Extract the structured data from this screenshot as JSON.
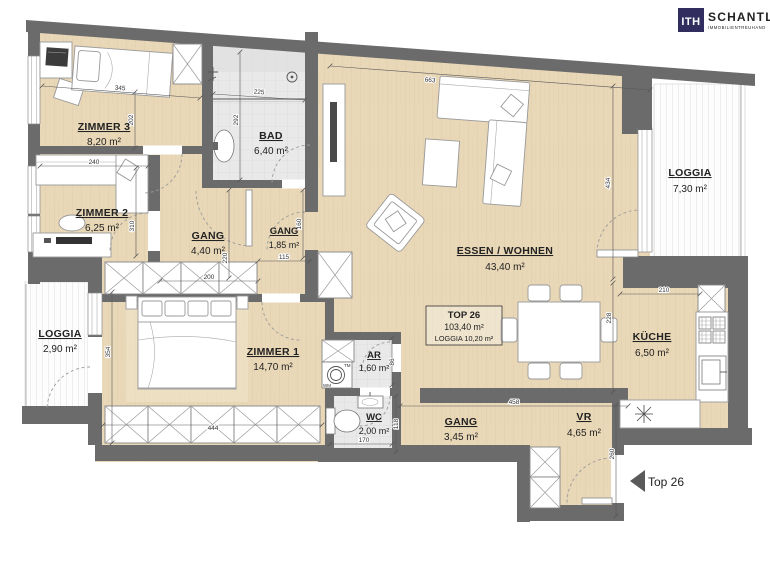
{
  "logo": {
    "mark": "ITH",
    "name": "SCHANTL",
    "tagline": "IMMOBILIENTREUHAND",
    "navy": "#312d5e",
    "accent": "#b9713f"
  },
  "unit": {
    "box_title": "TOP 26",
    "box_area": "103,40 m²",
    "box_loggia": "LOGGIA 10,20 m²",
    "entrance_label": "Top 26"
  },
  "rooms": [
    {
      "name": "ZIMMER 3",
      "area": "8,20 m²"
    },
    {
      "name": "ZIMMER 2",
      "area": "6,25 m²"
    },
    {
      "name": "BAD",
      "area": "6,40 m²"
    },
    {
      "name": "GANG",
      "area": "4,40 m²"
    },
    {
      "name": "GANG",
      "area": "1,85 m²"
    },
    {
      "name": "ESSEN / WOHNEN",
      "area": "43,40 m²"
    },
    {
      "name": "LOGGIA",
      "area": "7,30 m²"
    },
    {
      "name": "LOGGIA",
      "area": "2,90 m²"
    },
    {
      "name": "ZIMMER 1",
      "area": "14,70 m²"
    },
    {
      "name": "AR",
      "area": "1,60 m²"
    },
    {
      "name": "WC",
      "area": "2,00 m²"
    },
    {
      "name": "GANG",
      "area": "3,45 m²"
    },
    {
      "name": "VR",
      "area": "4,65 m²"
    },
    {
      "name": "KÜCHE",
      "area": "6,50 m²"
    }
  ],
  "dimensions": {
    "zimmer3_w": "345",
    "zimmer3_d": "202",
    "zimmer2_w": "240",
    "zimmer2_d": "310",
    "bad_w": "225",
    "bad_d": "292",
    "gang_w": "200",
    "gang_d": "220",
    "gang2_w": "115",
    "gang2_d": "160",
    "wohnen_w": "663",
    "wohnen_d": "434",
    "kueche_w": "210",
    "kueche_d": "228",
    "flur_w": "458",
    "ar_d": "86",
    "wc_d": "118",
    "wc_w": "170",
    "zimmer1_w": "444",
    "zimmer1_d": "354",
    "vr_d": "260"
  },
  "fixtures": {
    "wm_label": "WM",
    "tm_label": "TM"
  },
  "colors": {
    "wall": "#6b6b6b",
    "wood": "#e9d8b8",
    "tile": "#eaeaea"
  }
}
